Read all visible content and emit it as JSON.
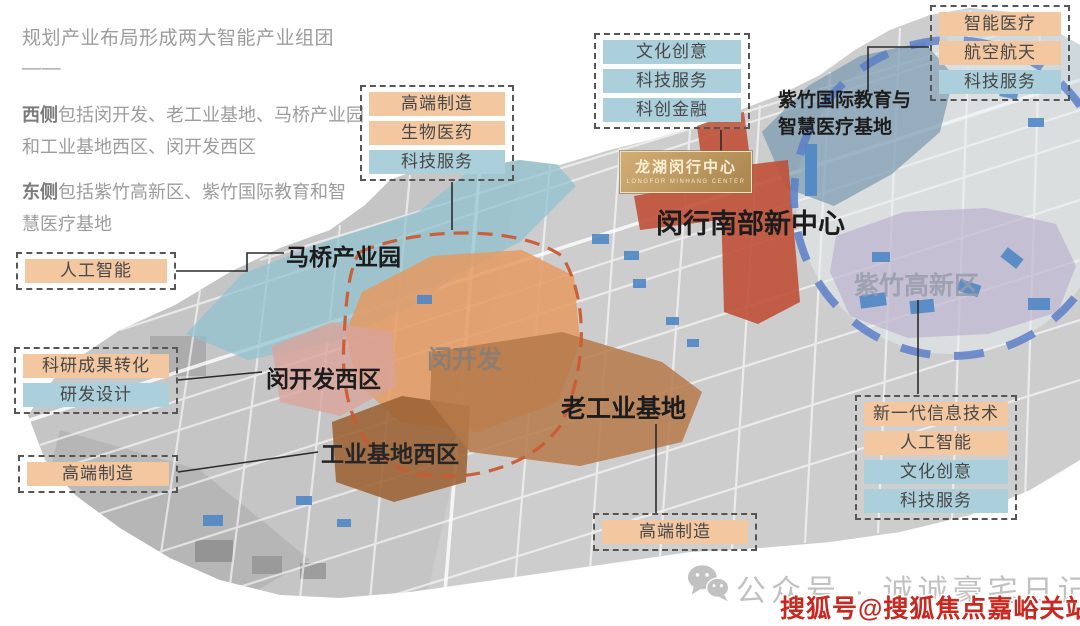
{
  "intro": {
    "title": "规划产业布局形成两大智能产业组团——",
    "west_label": "西侧",
    "west_text": "包括闵开发、老工业基地、马桥产业园\n和工业基地西区、闵开发西区",
    "east_label": "东侧",
    "east_text": "包括紫竹高新区、紫竹国际教育和智\n慧医疗基地"
  },
  "tag_groups": {
    "top_center": {
      "items": [
        {
          "label": "高端制造",
          "type": "orange"
        },
        {
          "label": "生物医药",
          "type": "orange"
        },
        {
          "label": "科技服务",
          "type": "blue"
        }
      ]
    },
    "top_mid": {
      "items": [
        {
          "label": "文化创意",
          "type": "blue"
        },
        {
          "label": "科技服务",
          "type": "blue"
        },
        {
          "label": "科创金融",
          "type": "blue"
        }
      ]
    },
    "top_right": {
      "items": [
        {
          "label": "智能医疗",
          "type": "orange"
        },
        {
          "label": "航空航天",
          "type": "orange"
        },
        {
          "label": "科技服务",
          "type": "blue"
        }
      ]
    },
    "left_ai": {
      "items": [
        {
          "label": "人工智能",
          "type": "orange"
        }
      ]
    },
    "left_rd": {
      "items": [
        {
          "label": "科研成果转化",
          "type": "orange"
        },
        {
          "label": "研发设计",
          "type": "blue"
        }
      ]
    },
    "left_mfg": {
      "items": [
        {
          "label": "高端制造",
          "type": "orange"
        }
      ]
    },
    "right_tech": {
      "items": [
        {
          "label": "新一代信息技术",
          "type": "orange"
        },
        {
          "label": "人工智能",
          "type": "orange"
        },
        {
          "label": "文化创意",
          "type": "blue"
        },
        {
          "label": "科技服务",
          "type": "blue"
        }
      ]
    },
    "bottom_mfg": {
      "items": [
        {
          "label": "高端制造",
          "type": "orange"
        }
      ]
    }
  },
  "map_labels": {
    "maqiao": "马桥产业园",
    "minhang_south_center": "闵行南部新中心",
    "zizhu_edu_medical": "紫竹国际教育与\n智慧医疗基地",
    "minkaifa_west": "闵开发西区",
    "minkaifa": "闵开发",
    "old_industrial_base": "老工业基地",
    "industrial_base_west": "工业基地西区",
    "zizhu_hitech": "紫竹高新区"
  },
  "logo": {
    "title": "龙湖闵行中心",
    "subtitle": "LONGFOR MINHANG CENTER"
  },
  "watermark": {
    "wechat_account": "公众号 · 诚诚豪宅日记",
    "sohu_account": "搜狐号@搜狐焦点嘉峪关站"
  },
  "colors": {
    "tag_orange": "#f3c8a1",
    "tag_blue": "#abd0db",
    "zone_minkaifa_orange": "#e59a61",
    "zone_red_center": "#c05138",
    "zone_teal_maqiao": "#8fc2ce",
    "zone_purple_zizhu": "#b0a6c6",
    "zone_bluegray_edu": "#7496ae",
    "dashed_circle_blue": "#5b7fc7",
    "dashed_outline_orange": "#cb5a33",
    "sohu_red": "#c8281f"
  }
}
